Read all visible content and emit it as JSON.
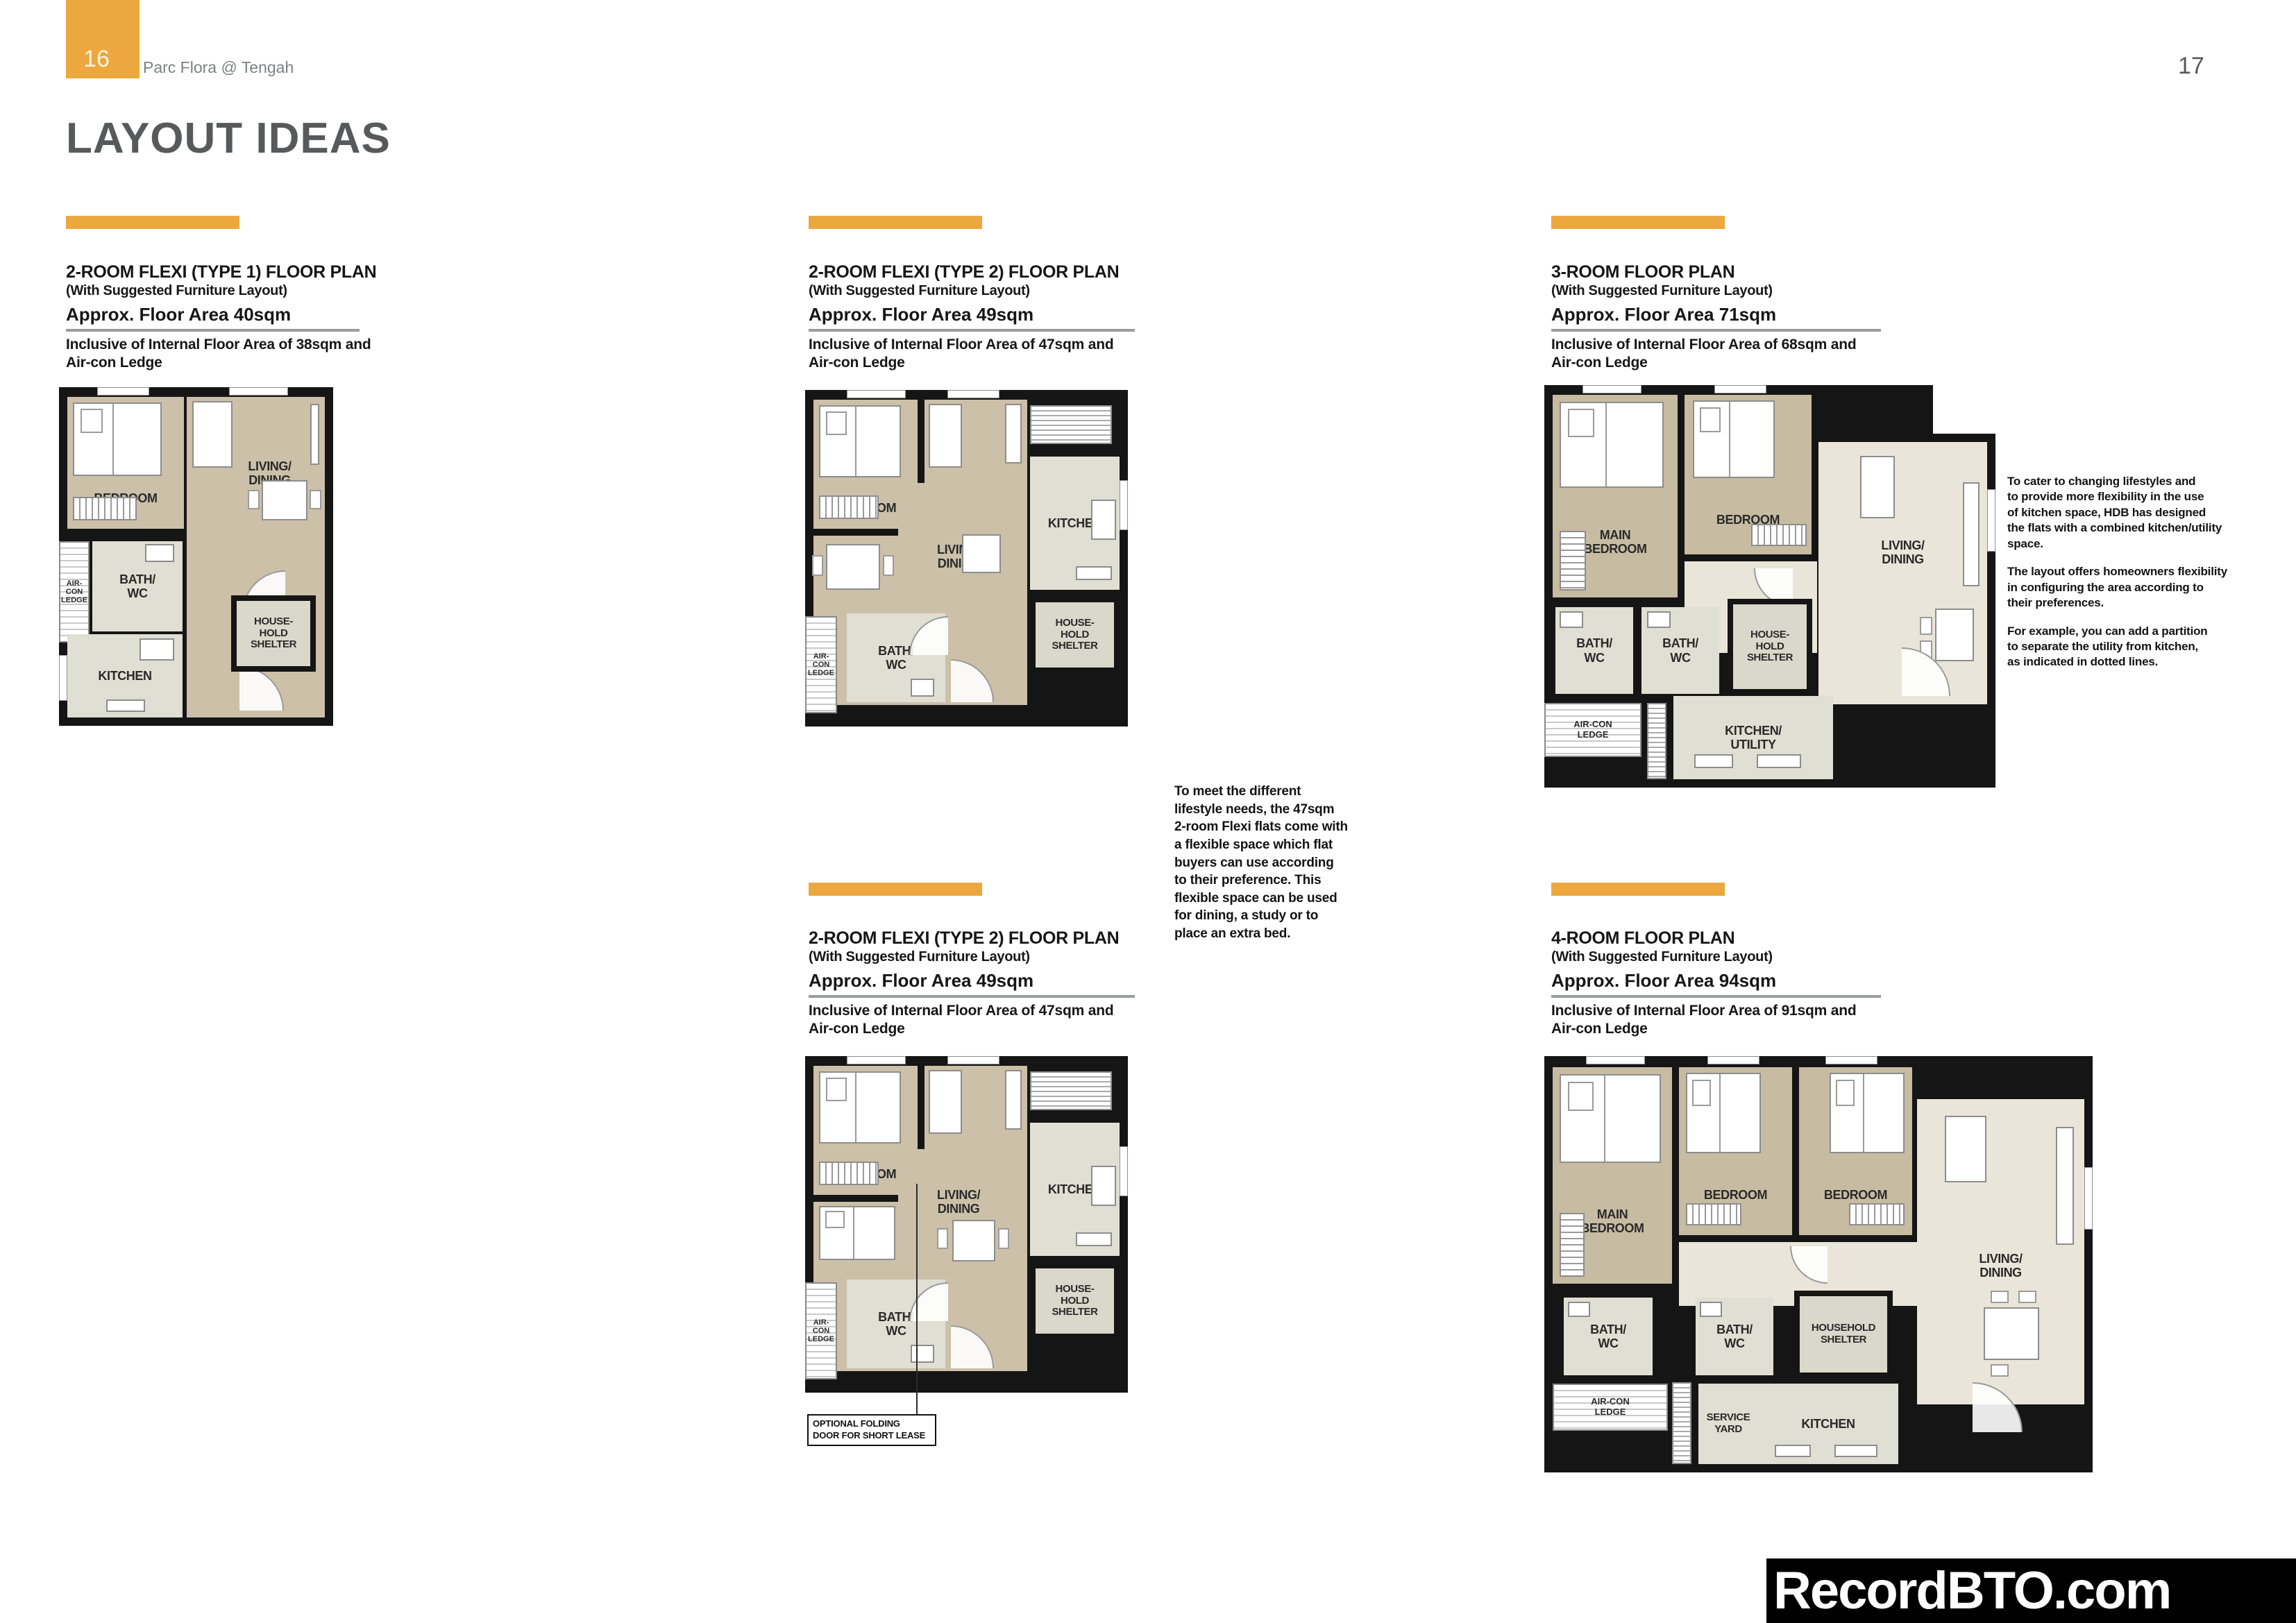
{
  "page": {
    "left_page_number": "16",
    "right_page_number": "17",
    "brand": "Parc Flora @ Tengah",
    "title": "LAYOUT IDEAS",
    "watermark": "RecordBTO.com"
  },
  "colors": {
    "accent_orange": "#ECA83E",
    "wall_black": "#151515",
    "bedroom_tan": "#CCC0A9",
    "living_cream": "#E9E5D8",
    "kitchen_sage": "#E0DFD3",
    "heading_gray": "#58595B"
  },
  "plans": [
    {
      "title": "2-ROOM FLEXI (TYPE 1) FLOOR PLAN",
      "subtitle": "(With Suggested Furniture Layout)",
      "area": "Approx. Floor Area 40sqm",
      "inclusive": "Inclusive of Internal Floor Area of 38sqm and\nAir-con Ledge",
      "rooms": {
        "bedroom": "BEDROOM",
        "living": "LIVING/\nDINING",
        "aircon": "AIR-\nCON\nLEDGE",
        "bath": "BATH/\nWC",
        "shelter": "HOUSE-\nHOLD\nSHELTER",
        "kitchen": "KITCHEN"
      }
    },
    {
      "title": "2-ROOM FLEXI (TYPE 2) FLOOR PLAN",
      "subtitle": "(With Suggested Furniture Layout)",
      "area": "Approx. Floor Area 49sqm",
      "inclusive": "Inclusive of Internal Floor Area of 47sqm and\nAir-con Ledge",
      "rooms": {
        "bedroom": "BEDROOM",
        "living": "LIVING/\nDINING",
        "kitchen": "KITCHEN",
        "aircon": "AIR-\nCON\nLEDGE",
        "bath": "BATH/\nWC",
        "shelter": "HOUSE-\nHOLD\nSHELTER"
      }
    },
    {
      "title": "3-ROOM FLOOR PLAN",
      "subtitle": "(With Suggested Furniture Layout)",
      "area": "Approx. Floor Area 71sqm",
      "inclusive": "Inclusive of Internal Floor Area of 68sqm and\nAir-con Ledge",
      "rooms": {
        "main_bedroom": "MAIN\nBEDROOM",
        "bedroom": "BEDROOM",
        "living": "LIVING/\nDINING",
        "bath1": "BATH/\nWC",
        "bath2": "BATH/\nWC",
        "shelter": "HOUSE-\nHOLD\nSHELTER",
        "aircon": "AIR-CON\nLEDGE",
        "kitchen": "KITCHEN/\nUTILITY"
      }
    },
    {
      "title": "2-ROOM FLEXI (TYPE 2) FLOOR PLAN",
      "subtitle": "(With Suggested Furniture Layout)",
      "area": "Approx. Floor Area 49sqm",
      "inclusive": "Inclusive of Internal Floor Area of 47sqm and\nAir-con Ledge",
      "rooms": {
        "bedroom": "BEDROOM",
        "living": "LIVING/\nDINING",
        "kitchen": "KITCHEN",
        "aircon": "AIR-\nCON\nLEDGE",
        "bath": "BATH/\nWC",
        "shelter": "HOUSE-\nHOLD\nSHELTER"
      },
      "callout": "OPTIONAL FOLDING\nDOOR FOR SHORT LEASE"
    },
    {
      "title": "4-ROOM FLOOR PLAN",
      "subtitle": "(With Suggested Furniture Layout)",
      "area": "Approx. Floor Area 94sqm",
      "inclusive": "Inclusive of Internal Floor Area of 91sqm and\nAir-con Ledge",
      "rooms": {
        "main_bedroom": "MAIN\nBEDROOM",
        "bedroom2": "BEDROOM",
        "bedroom3": "BEDROOM",
        "living": "LIVING/\nDINING",
        "bath1": "BATH/\nWC",
        "bath2": "BATH/\nWC",
        "shelter": "HOUSEHOLD\nSHELTER",
        "aircon": "AIR-CON\nLEDGE",
        "service": "SERVICE\nYARD",
        "kitchen": "KITCHEN"
      }
    }
  ],
  "notes": {
    "flexi": "To meet the different\nlifestyle needs, the 47sqm\n2-room Flexi flats come with\na flexible space which flat\nbuyers can use according\nto their preference. This\nflexible space can be used\nfor dining, a study or to\nplace an extra bed.",
    "kitchen_p1": "To cater to changing lifestyles and\nto provide more flexibility in the use\nof kitchen space, HDB has designed\nthe flats with a combined kitchen/utility\nspace.",
    "kitchen_p2": "The layout offers homeowners flexibility\nin configuring the area according to\ntheir preferences.",
    "kitchen_p3": "For example, you can add a partition\nto separate the utility from kitchen,\nas indicated in dotted lines."
  }
}
